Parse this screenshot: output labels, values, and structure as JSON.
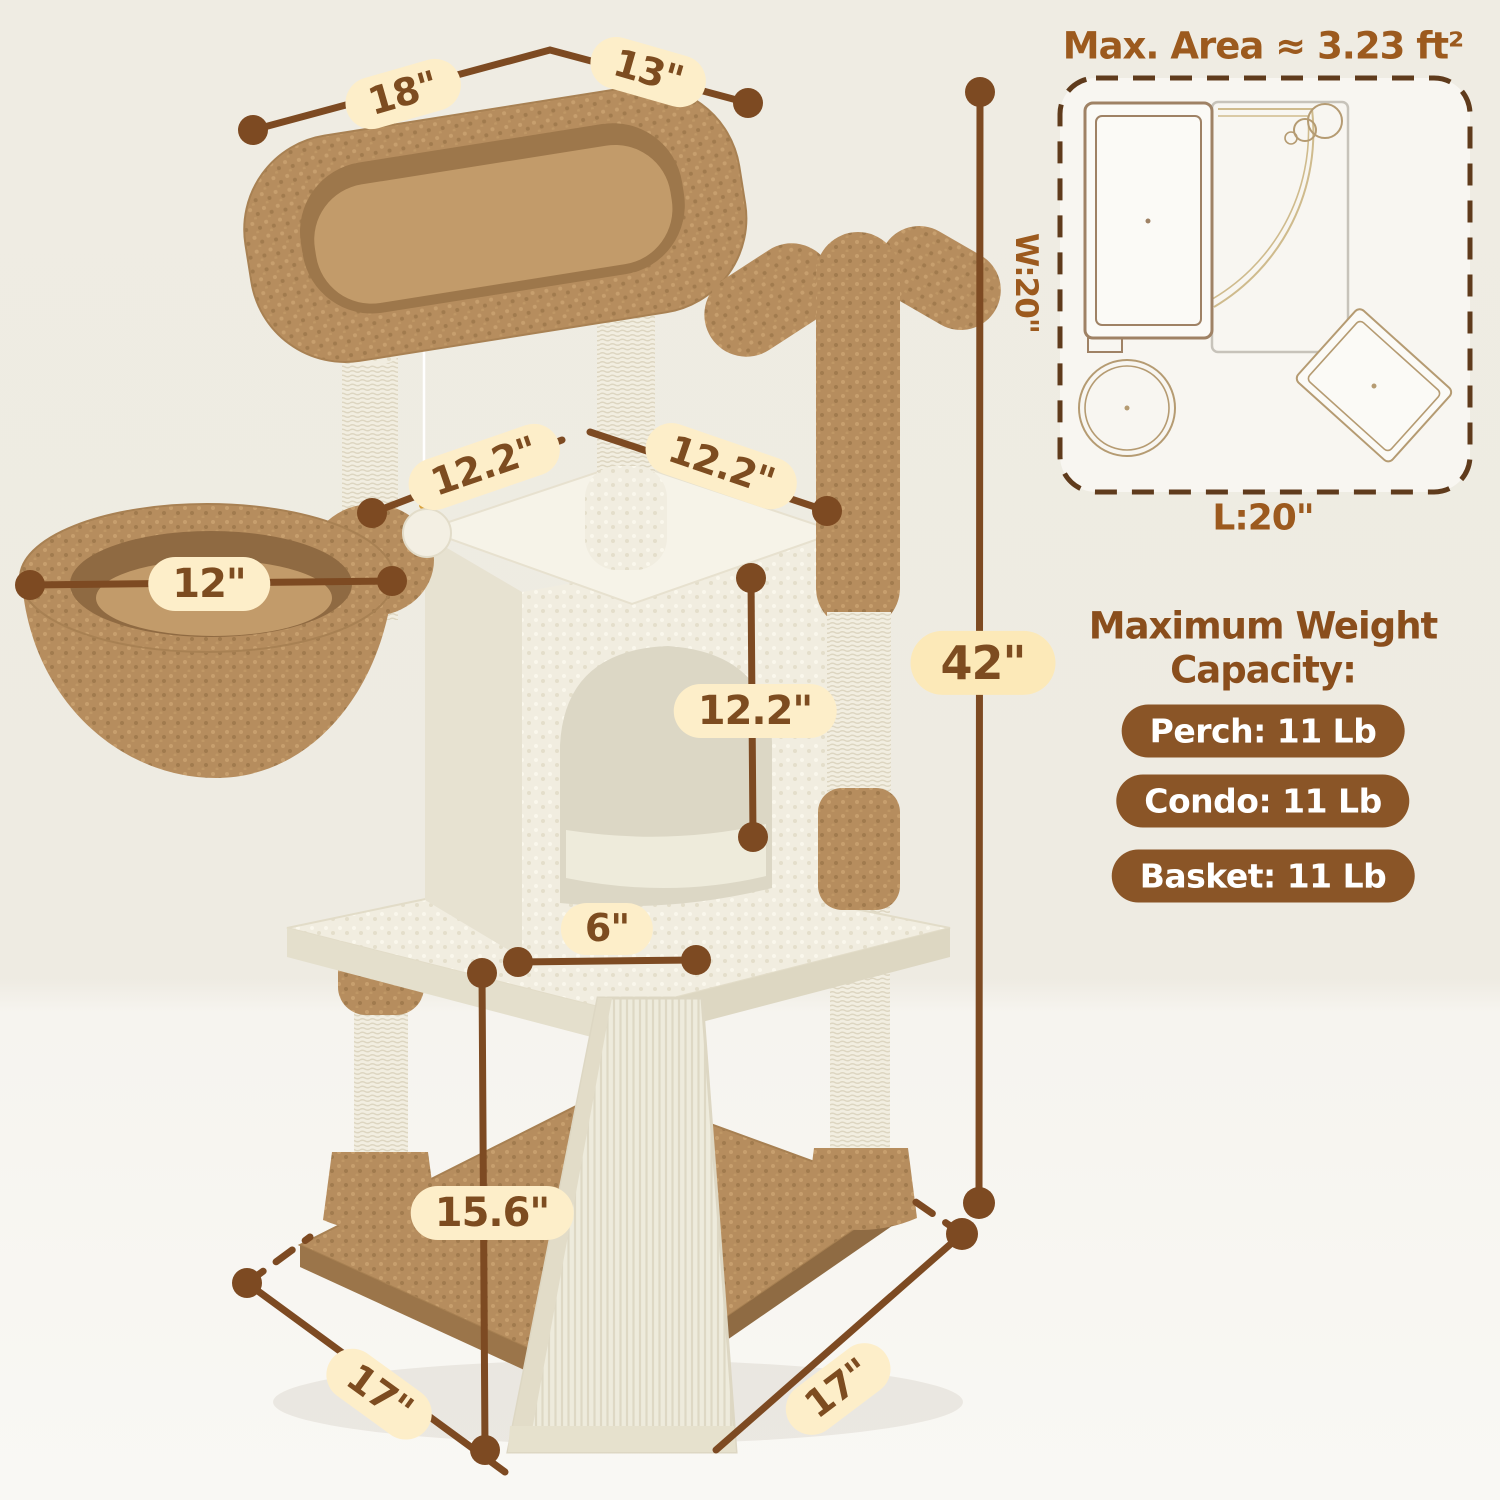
{
  "annotations": {
    "perch_width": "18\"",
    "perch_depth": "13\"",
    "top_width_left": "12.2\"",
    "top_width_right": "12.2\"",
    "basket_diameter": "12\"",
    "condo_height": "12.2\"",
    "ramp_top_width": "6\"",
    "ramp_length": "15.6\"",
    "base_side_left": "17\"",
    "base_side_right": "17\"",
    "total_height": "42\""
  },
  "floor_plan": {
    "title": "Max. Area ≈ 3.23 ft²",
    "width_label": "W:20\"",
    "length_label": "L:20\""
  },
  "weight": {
    "heading_line1": "Maximum Weight",
    "heading_line2": "Capacity:",
    "badges": [
      "Perch: 11 Lb",
      "Condo: 11 Lb",
      "Basket: 11 Lb"
    ]
  },
  "colors": {
    "dimension_line": "#7d4a22",
    "label_pill_bg": "#fdeec9",
    "heading_brown": "#9c5a1e",
    "badge_bg": "#8a5527",
    "plush_brown": "#b68d5e",
    "plush_cream": "#f1ede0"
  }
}
